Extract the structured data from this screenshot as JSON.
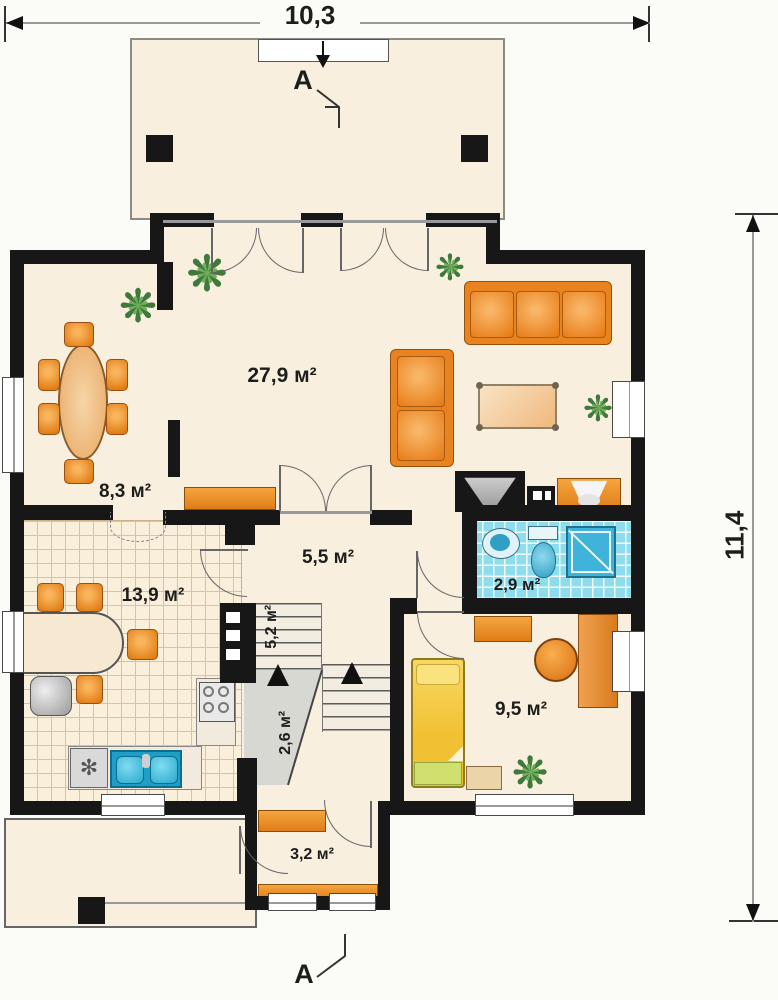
{
  "title": "house-first-floor-plan",
  "dimensions": {
    "width": "10,3",
    "height": "11,4"
  },
  "section_marker": "A",
  "rooms": {
    "living": {
      "area_label": "27,9 м²"
    },
    "dining": {
      "area_label": "8,3 м²"
    },
    "hall": {
      "area_label": "5,5 м²"
    },
    "bathroom": {
      "area_label": "2,9 м²"
    },
    "kitchen": {
      "area_label": "13,9 м²"
    },
    "stairs": {
      "area_label": "5,2 м²"
    },
    "under_stairs": {
      "area_label": "2,6 м²"
    },
    "bedroom": {
      "area_label": "9,5 м²"
    },
    "entry": {
      "area_label": "3,2 м²"
    }
  },
  "glyphs": {
    "plant": "❋",
    "swirl": "✻"
  },
  "colors": {
    "wall": "#171717",
    "floor_beige": "#f8efdf",
    "furniture_orange": "#ec8c2e",
    "bath_tile": "#8edcec",
    "water_blue": "#35aacd",
    "bed_yellow": "#f2c435",
    "blanket_green": "#cfe06e",
    "plant_green": "#4d8c46"
  }
}
